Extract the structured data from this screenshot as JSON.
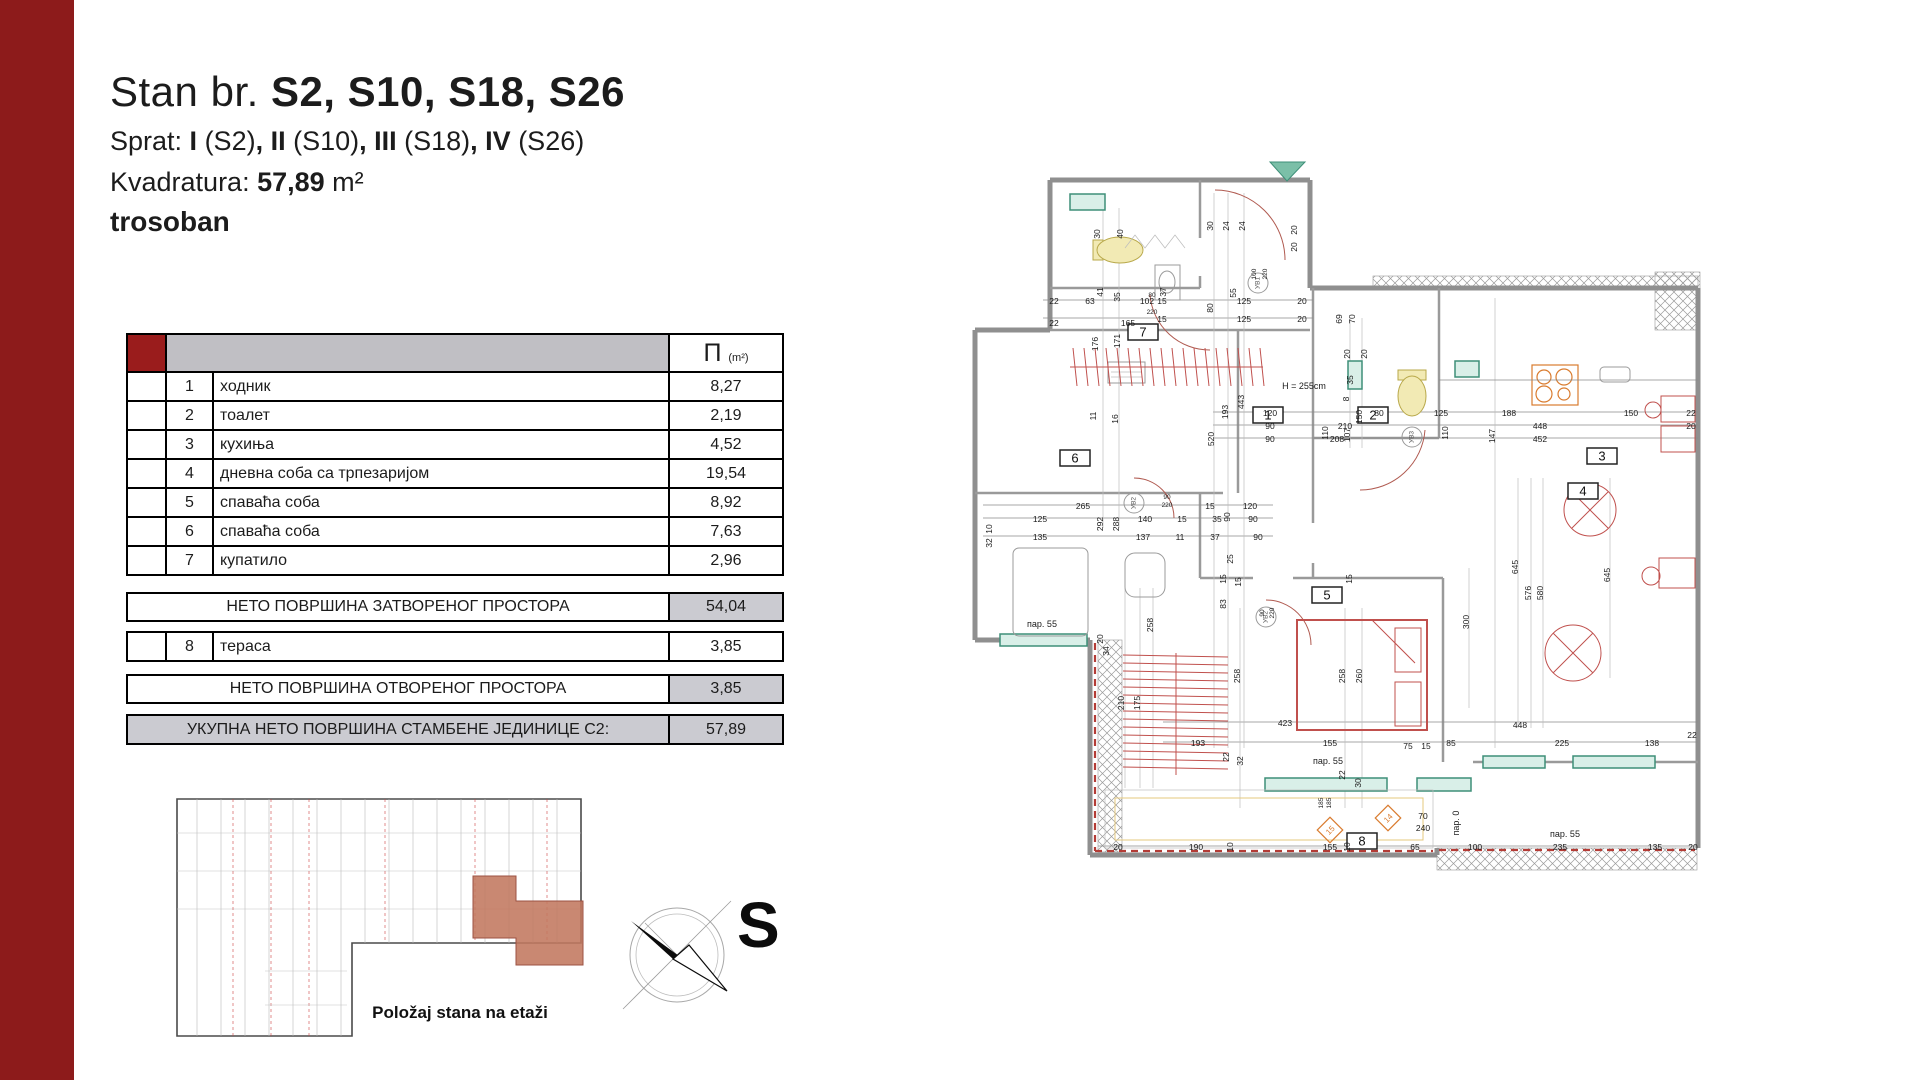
{
  "colors": {
    "accent_red": "#8d1b1b",
    "cell_red": "#9a1c1c",
    "header_gray": "#c0bfc4",
    "summary_gray": "#cbcbd1",
    "highlight_salmon": "#c1775f",
    "plan_red": "#c0504d",
    "plan_green": "#7bbfa8",
    "plan_yellow": "#f2eab4",
    "plan_orange": "#d97b2e",
    "wall_gray": "#8f8f8f"
  },
  "header": {
    "title_normal": "Stan br. ",
    "title_bold": "S2, S10, S18, S26",
    "sprat_segments": [
      {
        "t": "Sprat: ",
        "b": 0
      },
      {
        "t": "I",
        "b": 1
      },
      {
        "t": " (S2)",
        "b": 0
      },
      {
        "t": ", II",
        "b": 1
      },
      {
        "t": " (S10)",
        "b": 0
      },
      {
        "t": ", III",
        "b": 1
      },
      {
        "t": " (S18)",
        "b": 0
      },
      {
        "t": ", IV",
        "b": 1
      },
      {
        "t": " (S26)",
        "b": 0
      }
    ],
    "kvadratura_label": "Kvadratura: ",
    "kvadratura_value": "57,89",
    "kvadratura_unit": " m²",
    "apartment_type": "trosoban"
  },
  "table": {
    "area_symbol": "П",
    "area_unit": "(m²)",
    "rows": [
      {
        "num": "1",
        "name": "ходник",
        "area": "8,27"
      },
      {
        "num": "2",
        "name": "тоалет",
        "area": "2,19"
      },
      {
        "num": "3",
        "name": "кухиња",
        "area": "4,52"
      },
      {
        "num": "4",
        "name": "дневна соба са трпезаријом",
        "area": "19,54"
      },
      {
        "num": "5",
        "name": "спаваћа соба",
        "area": "8,92"
      },
      {
        "num": "6",
        "name": "спаваћа соба",
        "area": "7,63"
      },
      {
        "num": "7",
        "name": "купатило",
        "area": "2,96"
      }
    ],
    "summary_closed": {
      "label": "НЕТО ПОВРШИНА ЗАТВОРЕНОГ ПРОСТОРА",
      "value": "54,04"
    },
    "terrace_row": {
      "num": "8",
      "name": "тераса",
      "area": "3,85"
    },
    "summary_open": {
      "label": "НЕТО ПОВРШИНА ОТВОРЕНОГ ПРОСТОРА",
      "value": "3,85"
    },
    "total_row": {
      "label": "УКУПНА НЕТО ПОВРШИНА СТАМБЕНЕ ЈЕДИНИЦЕ С2:",
      "value": "57,89"
    }
  },
  "mini_plan": {
    "caption": "Položaj stana na etaži"
  },
  "compass": {
    "label": "S"
  },
  "plan": {
    "room_boxes": [
      {
        "n": "1",
        "x": 470,
        "y": 259
      },
      {
        "n": "2",
        "x": 575,
        "y": 259
      },
      {
        "n": "3",
        "x": 804,
        "y": 300
      },
      {
        "n": "4",
        "x": 785,
        "y": 335
      },
      {
        "n": "5",
        "x": 529,
        "y": 439
      },
      {
        "n": "6",
        "x": 277,
        "y": 302
      },
      {
        "n": "7",
        "x": 345,
        "y": 176
      },
      {
        "n": "8",
        "x": 564,
        "y": 685
      }
    ],
    "uv_markers": [
      {
        "t": "УВ1",
        "x": 475,
        "y": 135
      },
      {
        "t": "УВ2",
        "x": 351,
        "y": 355
      },
      {
        "t": "УВ2",
        "x": 483,
        "y": 469
      },
      {
        "t": "УВ3",
        "x": 629,
        "y": 289
      }
    ],
    "diamond_markers": [
      {
        "t": "15",
        "x": 547,
        "y": 682
      },
      {
        "t": "14",
        "x": 605,
        "y": 670
      }
    ],
    "labels": [
      {
        "t": "22",
        "x": 271,
        "y": 156
      },
      {
        "t": "63",
        "x": 307,
        "y": 156
      },
      {
        "t": "102",
        "x": 364,
        "y": 156
      },
      {
        "t": "22",
        "x": 271,
        "y": 178
      },
      {
        "t": "165",
        "x": 345,
        "y": 178
      },
      {
        "t": "80",
        "x": 369,
        "y": 149,
        "s": 6.5
      },
      {
        "t": "15",
        "x": 379,
        "y": 156
      },
      {
        "t": "220",
        "x": 369,
        "y": 166,
        "s": 6.5
      },
      {
        "t": "15",
        "x": 379,
        "y": 174
      },
      {
        "t": "125",
        "x": 461,
        "y": 156
      },
      {
        "t": "125",
        "x": 461,
        "y": 174
      },
      {
        "t": "20",
        "x": 519,
        "y": 156
      },
      {
        "t": "20",
        "x": 519,
        "y": 174
      },
      {
        "t": "80",
        "x": 430,
        "y": 160,
        "r": 1
      },
      {
        "t": "30",
        "x": 317,
        "y": 86,
        "r": 1
      },
      {
        "t": "40",
        "x": 340,
        "y": 86,
        "r": 1
      },
      {
        "t": "41",
        "x": 320,
        "y": 144,
        "r": 1
      },
      {
        "t": "35",
        "x": 337,
        "y": 149,
        "r": 1
      },
      {
        "t": "37",
        "x": 383,
        "y": 144,
        "r": 1
      },
      {
        "t": "30",
        "x": 430,
        "y": 78,
        "r": 1
      },
      {
        "t": "24",
        "x": 446,
        "y": 78,
        "r": 1
      },
      {
        "t": "24",
        "x": 462,
        "y": 78,
        "r": 1
      },
      {
        "t": "55",
        "x": 453,
        "y": 145,
        "r": 1
      },
      {
        "t": "100",
        "x": 473,
        "y": 126,
        "r": 1,
        "s": 6.5
      },
      {
        "t": "220",
        "x": 484,
        "y": 126,
        "r": 1,
        "s": 6.5
      },
      {
        "t": "176",
        "x": 315,
        "y": 196,
        "r": 1
      },
      {
        "t": "171",
        "x": 337,
        "y": 193,
        "r": 1
      },
      {
        "t": "11",
        "x": 313,
        "y": 268,
        "r": 1
      },
      {
        "t": "16",
        "x": 335,
        "y": 271,
        "r": 1
      },
      {
        "t": "H = 255cm",
        "x": 521,
        "y": 241,
        "s": 9
      },
      {
        "t": "520",
        "x": 431,
        "y": 291,
        "r": 1
      },
      {
        "t": "193",
        "x": 445,
        "y": 264,
        "r": 1
      },
      {
        "t": "443",
        "x": 461,
        "y": 254,
        "r": 1
      },
      {
        "t": "107",
        "x": 567,
        "y": 287,
        "r": 1
      },
      {
        "t": "150",
        "x": 579,
        "y": 269,
        "r": 1
      },
      {
        "t": "8",
        "x": 566,
        "y": 251,
        "r": 1
      },
      {
        "t": "35",
        "x": 570,
        "y": 232,
        "r": 1
      },
      {
        "t": "20",
        "x": 567,
        "y": 206,
        "r": 1
      },
      {
        "t": "20",
        "x": 584,
        "y": 206,
        "r": 1
      },
      {
        "t": "147",
        "x": 712,
        "y": 288,
        "r": 1
      },
      {
        "t": "69",
        "x": 559,
        "y": 171,
        "r": 1
      },
      {
        "t": "70",
        "x": 572,
        "y": 171,
        "r": 1
      },
      {
        "t": "120",
        "x": 487,
        "y": 268
      },
      {
        "t": "80",
        "x": 596,
        "y": 268
      },
      {
        "t": "125",
        "x": 658,
        "y": 268
      },
      {
        "t": "188",
        "x": 726,
        "y": 268
      },
      {
        "t": "150",
        "x": 848,
        "y": 268
      },
      {
        "t": "22",
        "x": 908,
        "y": 268
      },
      {
        "t": "90",
        "x": 487,
        "y": 281
      },
      {
        "t": "210",
        "x": 562,
        "y": 281
      },
      {
        "t": "448",
        "x": 757,
        "y": 281
      },
      {
        "t": "20",
        "x": 908,
        "y": 281
      },
      {
        "t": "90",
        "x": 487,
        "y": 294
      },
      {
        "t": "208",
        "x": 554,
        "y": 294
      },
      {
        "t": "452",
        "x": 757,
        "y": 294
      },
      {
        "t": "110",
        "x": 545,
        "y": 285,
        "r": 1
      },
      {
        "t": "110",
        "x": 665,
        "y": 285,
        "r": 1
      },
      {
        "t": "265",
        "x": 300,
        "y": 361
      },
      {
        "t": "15",
        "x": 427,
        "y": 361
      },
      {
        "t": "120",
        "x": 467,
        "y": 361
      },
      {
        "t": "125",
        "x": 257,
        "y": 374
      },
      {
        "t": "292",
        "x": 320,
        "y": 376,
        "r": 1
      },
      {
        "t": "288",
        "x": 336,
        "y": 376,
        "r": 1
      },
      {
        "t": "140",
        "x": 362,
        "y": 374
      },
      {
        "t": "15",
        "x": 399,
        "y": 374
      },
      {
        "t": "35",
        "x": 434,
        "y": 374
      },
      {
        "t": "90",
        "x": 470,
        "y": 374
      },
      {
        "t": "135",
        "x": 257,
        "y": 392
      },
      {
        "t": "137",
        "x": 360,
        "y": 392
      },
      {
        "t": "11",
        "x": 397,
        "y": 392
      },
      {
        "t": "37",
        "x": 432,
        "y": 392
      },
      {
        "t": "90",
        "x": 475,
        "y": 392
      },
      {
        "t": "90",
        "x": 384,
        "y": 351,
        "s": 6.5
      },
      {
        "t": "220",
        "x": 384,
        "y": 359,
        "s": 6.5
      },
      {
        "t": "90",
        "x": 447,
        "y": 369,
        "r": 1
      },
      {
        "t": "25",
        "x": 450,
        "y": 411,
        "r": 1
      },
      {
        "t": "15",
        "x": 443,
        "y": 431,
        "r": 1
      },
      {
        "t": "15",
        "x": 458,
        "y": 434,
        "r": 1
      },
      {
        "t": "83",
        "x": 443,
        "y": 456,
        "r": 1
      },
      {
        "t": "90",
        "x": 481,
        "y": 465,
        "r": 1,
        "s": 6.5
      },
      {
        "t": "220",
        "x": 491,
        "y": 465,
        "r": 1,
        "s": 6.5
      },
      {
        "t": "15",
        "x": 569,
        "y": 431,
        "r": 1
      },
      {
        "t": "10",
        "x": 209,
        "y": 381,
        "r": 1
      },
      {
        "t": "32",
        "x": 209,
        "y": 395,
        "r": 1
      },
      {
        "t": "пар. 55",
        "x": 259,
        "y": 479,
        "s": 9
      },
      {
        "t": "20",
        "x": 320,
        "y": 491,
        "r": 1
      },
      {
        "t": "34",
        "x": 326,
        "y": 503,
        "r": 1
      },
      {
        "t": "210",
        "x": 341,
        "y": 555,
        "r": 1
      },
      {
        "t": "175",
        "x": 357,
        "y": 555,
        "r": 1
      },
      {
        "t": "258",
        "x": 370,
        "y": 477,
        "r": 1
      },
      {
        "t": "258",
        "x": 457,
        "y": 528,
        "r": 1
      },
      {
        "t": "258",
        "x": 562,
        "y": 528,
        "r": 1
      },
      {
        "t": "260",
        "x": 579,
        "y": 528,
        "r": 1
      },
      {
        "t": "300",
        "x": 686,
        "y": 474,
        "r": 1
      },
      {
        "t": "645",
        "x": 735,
        "y": 419,
        "r": 1
      },
      {
        "t": "576",
        "x": 748,
        "y": 445,
        "r": 1
      },
      {
        "t": "580",
        "x": 760,
        "y": 445,
        "r": 1
      },
      {
        "t": "645",
        "x": 827,
        "y": 427,
        "r": 1
      },
      {
        "t": "423",
        "x": 502,
        "y": 578
      },
      {
        "t": "193",
        "x": 415,
        "y": 598
      },
      {
        "t": "155",
        "x": 547,
        "y": 598
      },
      {
        "t": "75",
        "x": 625,
        "y": 601
      },
      {
        "t": "15",
        "x": 643,
        "y": 601
      },
      {
        "t": "85",
        "x": 668,
        "y": 598
      },
      {
        "t": "225",
        "x": 779,
        "y": 598
      },
      {
        "t": "138",
        "x": 869,
        "y": 598
      },
      {
        "t": "22",
        "x": 909,
        "y": 590
      },
      {
        "t": "448",
        "x": 737,
        "y": 580
      },
      {
        "t": "пар. 55",
        "x": 545,
        "y": 616,
        "s": 9
      },
      {
        "t": "22",
        "x": 446,
        "y": 609,
        "r": 1
      },
      {
        "t": "32",
        "x": 460,
        "y": 613,
        "r": 1
      },
      {
        "t": "22",
        "x": 562,
        "y": 627,
        "r": 1
      },
      {
        "t": "30",
        "x": 578,
        "y": 635,
        "r": 1
      },
      {
        "t": "20",
        "x": 335,
        "y": 702
      },
      {
        "t": "190",
        "x": 413,
        "y": 702
      },
      {
        "t": "10",
        "x": 450,
        "y": 699,
        "r": 1
      },
      {
        "t": "155",
        "x": 547,
        "y": 702
      },
      {
        "t": "10",
        "x": 567,
        "y": 699,
        "r": 1
      },
      {
        "t": "65",
        "x": 632,
        "y": 702
      },
      {
        "t": "100",
        "x": 692,
        "y": 702
      },
      {
        "t": "235",
        "x": 777,
        "y": 702
      },
      {
        "t": "135",
        "x": 872,
        "y": 702
      },
      {
        "t": "20",
        "x": 910,
        "y": 702
      },
      {
        "t": "пар. 55",
        "x": 782,
        "y": 689,
        "s": 9
      },
      {
        "t": "пар. 0",
        "x": 676,
        "y": 675,
        "r": 1,
        "s": 9
      },
      {
        "t": "70",
        "x": 640,
        "y": 671,
        "c": "o"
      },
      {
        "t": "240",
        "x": 640,
        "y": 683,
        "c": "o"
      },
      {
        "t": "185",
        "x": 540,
        "y": 655,
        "r": 1,
        "c": "o",
        "s": 6.5
      },
      {
        "t": "185",
        "x": 548,
        "y": 655,
        "r": 1,
        "c": "o",
        "s": 6.5
      },
      {
        "t": "20",
        "x": 514,
        "y": 82,
        "r": 1
      },
      {
        "t": "20",
        "x": 514,
        "y": 99,
        "r": 1
      }
    ]
  }
}
